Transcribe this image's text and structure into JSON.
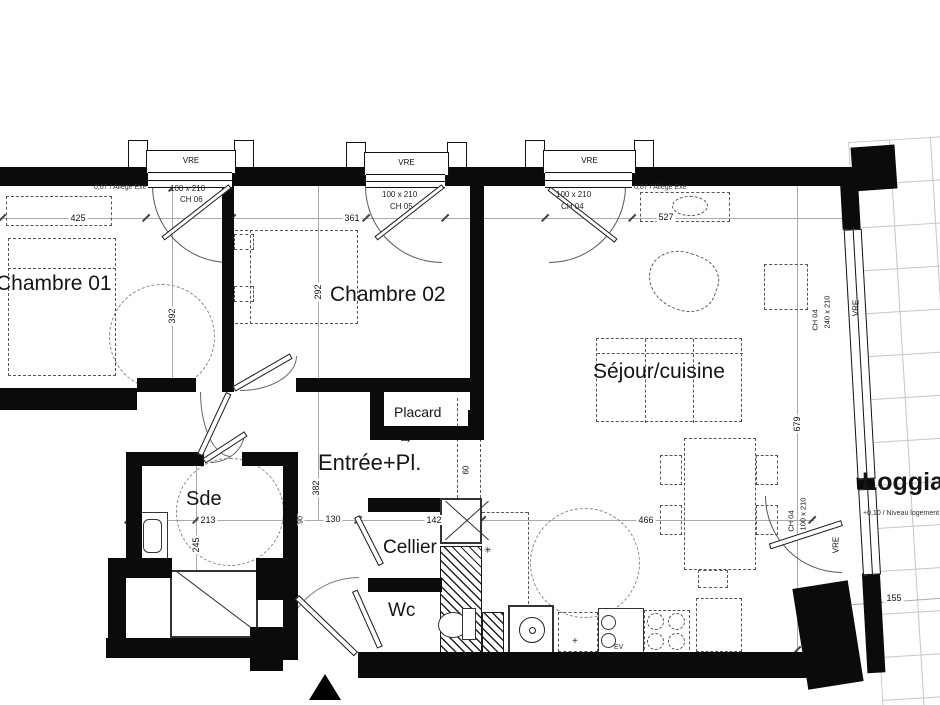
{
  "plan": {
    "rooms": {
      "chambre01": "Chambre 01",
      "chambre02": "Chambre 02",
      "sejour": "Séjour/cuisine",
      "entree": "Entrée+Pl.",
      "placard": "Placard",
      "sde": "Sde",
      "cellier": "Cellier",
      "wc": "Wc",
      "loggia": "Loggia",
      "loggia_level": "+0,10 / Niveau logement"
    },
    "dims": {
      "ch01_w": "425",
      "ch02_w": "361",
      "sejour_w": "527",
      "ch01_h": "392",
      "ch02_h": "292",
      "sejour_h": "679",
      "entree_h": "382",
      "sde_w": "213",
      "sde_h": "245",
      "hall": "130",
      "cellier_w": "142",
      "sejour_low": "466",
      "loggia_w": "155",
      "passage": "60",
      "door_w": "90"
    },
    "windows": {
      "vre": "VRE",
      "w1_size": "100 x 210",
      "w1_ref": "CH 06",
      "w2_size": "100 x 210",
      "w2_ref": "CH 05",
      "w3_size": "100 x 210",
      "w3_ref": "CH 04",
      "bay_size": "240 x 210",
      "bay_ref": "CH 04",
      "door_size": "100 x 210",
      "door_ref": "CH 04",
      "allege": "0,67 / Allège Exé"
    },
    "kitchen": {
      "sink_label": "EV"
    },
    "symbols": {
      "placard_arrow": "→",
      "drain": "✳",
      "plus": "+"
    }
  }
}
